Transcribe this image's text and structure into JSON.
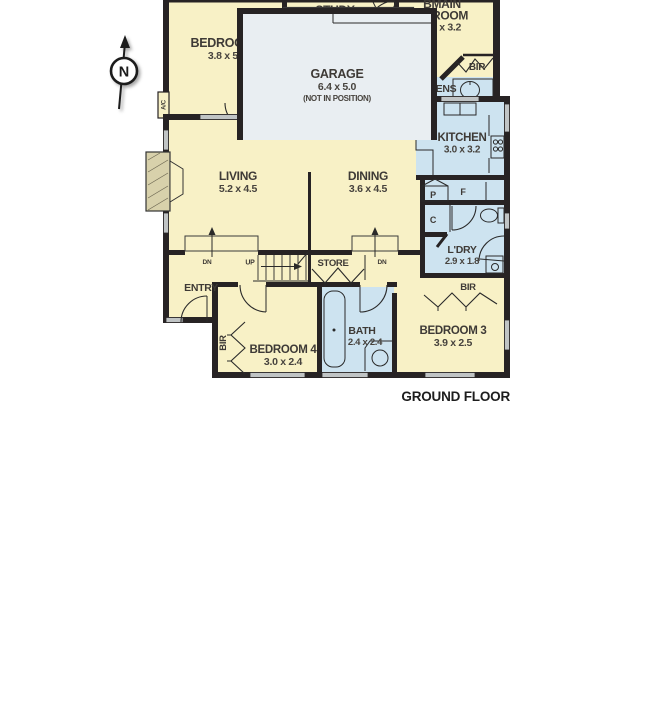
{
  "plan": {
    "first_floor": {
      "floor_label": "FIRST FLOOR",
      "bedroom2": {
        "name": "BEDROOM 2",
        "dims": "3.8 x 5.6"
      },
      "study": {
        "name": "STUDY",
        "dims": "3.4 x 3.6"
      },
      "main_bedroom": {
        "name_line1": "BMAIN",
        "name_line2": "EDROOM",
        "dims": "3.6 x 3.2"
      },
      "ens": {
        "name": "ENS",
        "dims": "2.5 x 2.3"
      },
      "bir": {
        "name": "BIR"
      },
      "ac_unit": {
        "name": "A/C"
      },
      "stairs": {
        "dn": "DN"
      }
    },
    "ground_floor": {
      "floor_label": "GROUND FLOOR",
      "patio": {
        "name": "PATIO",
        "dims": "4.3 x 3.3"
      },
      "living": {
        "name": "LIVING",
        "dims": "5.2 x 4.5"
      },
      "dining": {
        "name": "DINING",
        "dims": "3.6 x 4.5"
      },
      "kitchen": {
        "name": "KITCHEN",
        "dims": "3.0 x 3.2"
      },
      "pantry": {
        "name": "P"
      },
      "fridge": {
        "name": "F"
      },
      "cupboard": {
        "name": "C"
      },
      "laundry": {
        "name": "L'DRY",
        "dims": "2.9 x 1.8"
      },
      "bir_bed3": {
        "name": "BIR"
      },
      "entry": {
        "name": "ENTRY"
      },
      "store": {
        "name": "STORE"
      },
      "stairs": {
        "up": "UP"
      },
      "step_left": {
        "dn": "DN"
      },
      "step_right": {
        "dn": "DN"
      },
      "bir_bed4": {
        "name": "BIR"
      },
      "bedroom4": {
        "name": "BEDROOM 4",
        "dims": "3.0 x 2.4"
      },
      "bath": {
        "name": "BATH",
        "dims": "2.4 x 2.4"
      },
      "bedroom3": {
        "name": "BEDROOM 3",
        "dims": "3.9 x 2.5"
      }
    },
    "garage": {
      "name": "GARAGE",
      "dims": "6.4 x 5.0",
      "note": "(NOT IN POSITION)"
    },
    "compass": {
      "north": "N"
    },
    "colors": {
      "room_cream": "#f8f1c6",
      "wet_blue": "#cde3f0",
      "patio_grey": "#e6ebee",
      "garage_grey": "#e9eef2",
      "wall": "#272324",
      "window_grey": "#c0c4c5",
      "fireplace_tan": "#d8d1ab"
    }
  }
}
